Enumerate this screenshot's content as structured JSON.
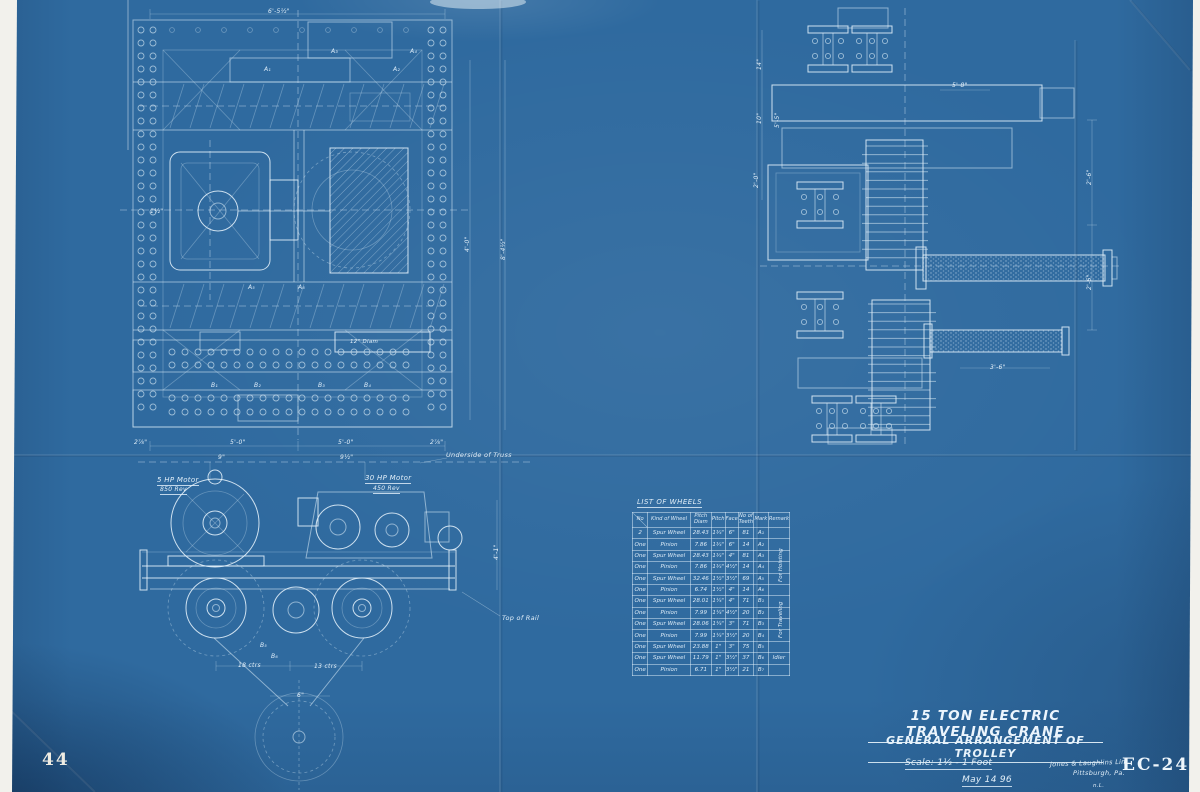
{
  "sheet_number": "44",
  "title_block": {
    "title": "15 TON ELECTRIC TRAVELING CRANE",
    "subtitle": "GENERAL ARRANGEMENT OF TROLLEY",
    "scale": "Scale: 1½ - 1 Foot",
    "date": "May 14 96",
    "company_line1": "Jones & Laughlins Lim.",
    "company_line2": "Pittsburgh, Pa.",
    "draftsman_initials": "n.L.",
    "drawing_number": "EC-24"
  },
  "labels": {
    "motor_small": "5 HP Motor",
    "motor_small_speed": "850 Rev",
    "motor_large": "30 HP Motor",
    "motor_large_speed": "450 Rev",
    "underside_of_truss": "Underside of Truss",
    "top_of_rail": "Top of Rail",
    "drum_diameter": "12\" Diam"
  },
  "list_of_wheels": {
    "caption": "LIST OF WHEELS",
    "headers": [
      "No",
      "Kind of Wheel",
      "Pitch Diam",
      "Pitch",
      "Face",
      "No of Teeth",
      "Mark",
      "Remark"
    ],
    "rows": [
      {
        "qty": "2",
        "kind": "Spur Wheel",
        "pitch_diam": "28.43",
        "pitch": "1¾\"",
        "face": "6\"",
        "teeth": "81",
        "mark": "A₁",
        "remark": ""
      },
      {
        "qty": "One",
        "kind": "Pinion",
        "pitch_diam": "7.86",
        "pitch": "1¾\"",
        "face": "6\"",
        "teeth": "14",
        "mark": "A₂",
        "remark": ""
      },
      {
        "qty": "One",
        "kind": "Spur Wheel",
        "pitch_diam": "28.43",
        "pitch": "1¾\"",
        "face": "4\"",
        "teeth": "81",
        "mark": "A₃",
        "remark": ""
      },
      {
        "qty": "One",
        "kind": "Pinion",
        "pitch_diam": "7.86",
        "pitch": "1¾\"",
        "face": "4½\"",
        "teeth": "14",
        "mark": "A₄",
        "remark": ""
      },
      {
        "qty": "One",
        "kind": "Spur Wheel",
        "pitch_diam": "32.46",
        "pitch": "1½\"",
        "face": "3½\"",
        "teeth": "69",
        "mark": "A₅",
        "remark": ""
      },
      {
        "qty": "One",
        "kind": "Pinion",
        "pitch_diam": "6.74",
        "pitch": "1½\"",
        "face": "4\"",
        "teeth": "14",
        "mark": "A₆",
        "remark": ""
      },
      {
        "qty": "One",
        "kind": "Spur Wheel",
        "pitch_diam": "28.01",
        "pitch": "1¼\"",
        "face": "4\"",
        "teeth": "71",
        "mark": "B₁",
        "remark": ""
      },
      {
        "qty": "One",
        "kind": "Pinion",
        "pitch_diam": "7.99",
        "pitch": "1¼\"",
        "face": "4½\"",
        "teeth": "20",
        "mark": "B₂",
        "remark": ""
      },
      {
        "qty": "One",
        "kind": "Spur Wheel",
        "pitch_diam": "28.06",
        "pitch": "1¼\"",
        "face": "3\"",
        "teeth": "71",
        "mark": "B₃",
        "remark": ""
      },
      {
        "qty": "One",
        "kind": "Pinion",
        "pitch_diam": "7.99",
        "pitch": "1¼\"",
        "face": "3½\"",
        "teeth": "20",
        "mark": "B₄",
        "remark": ""
      },
      {
        "qty": "One",
        "kind": "Spur Wheel",
        "pitch_diam": "23.88",
        "pitch": "1\"",
        "face": "3\"",
        "teeth": "75",
        "mark": "B₅",
        "remark": ""
      },
      {
        "qty": "One",
        "kind": "Spur Wheel",
        "pitch_diam": "11.79",
        "pitch": "1\"",
        "face": "3½\"",
        "teeth": "37",
        "mark": "B₆",
        "remark": "Idler"
      },
      {
        "qty": "One",
        "kind": "Pinion",
        "pitch_diam": "6.71",
        "pitch": "1\"",
        "face": "3½\"",
        "teeth": "21",
        "mark": "B₇",
        "remark": ""
      }
    ],
    "remark_groups": {
      "hoisting": "For Hoisting",
      "traveling": "For Traveling"
    }
  },
  "dims": {
    "plan_top": "6'-5½\"",
    "plan_left": "1½\"",
    "plan_b_left": "2⅞\"",
    "plan_b_c1": "5'-0\"",
    "plan_b_c2": "5'-0\"",
    "plan_b_right": "2⅞\"",
    "plan_b_s1": "9\"",
    "plan_b_s2": "9½\"",
    "mid_v1": "4'-0\"",
    "mid_v2": "8'-4½\"",
    "side_l1": "14\"",
    "side_l2": "10\"",
    "side_l3": "5'-5\"",
    "side_l4": "2'-0\"",
    "side_t": "5'-8\"",
    "side_r1": "2'-6\"",
    "side_r2": "2'-6\"",
    "side_b": "3'-6\"",
    "elev_w1": "18 ctrs",
    "elev_w2": "13 ctrs",
    "elev_c": "6\"",
    "elev_v": "4'-1\""
  },
  "marks": [
    "A₁",
    "A₂",
    "A₃",
    "A₄",
    "A₅",
    "A₆",
    "B₁",
    "B₂",
    "B₃",
    "B₄",
    "B₅",
    "B₆"
  ]
}
